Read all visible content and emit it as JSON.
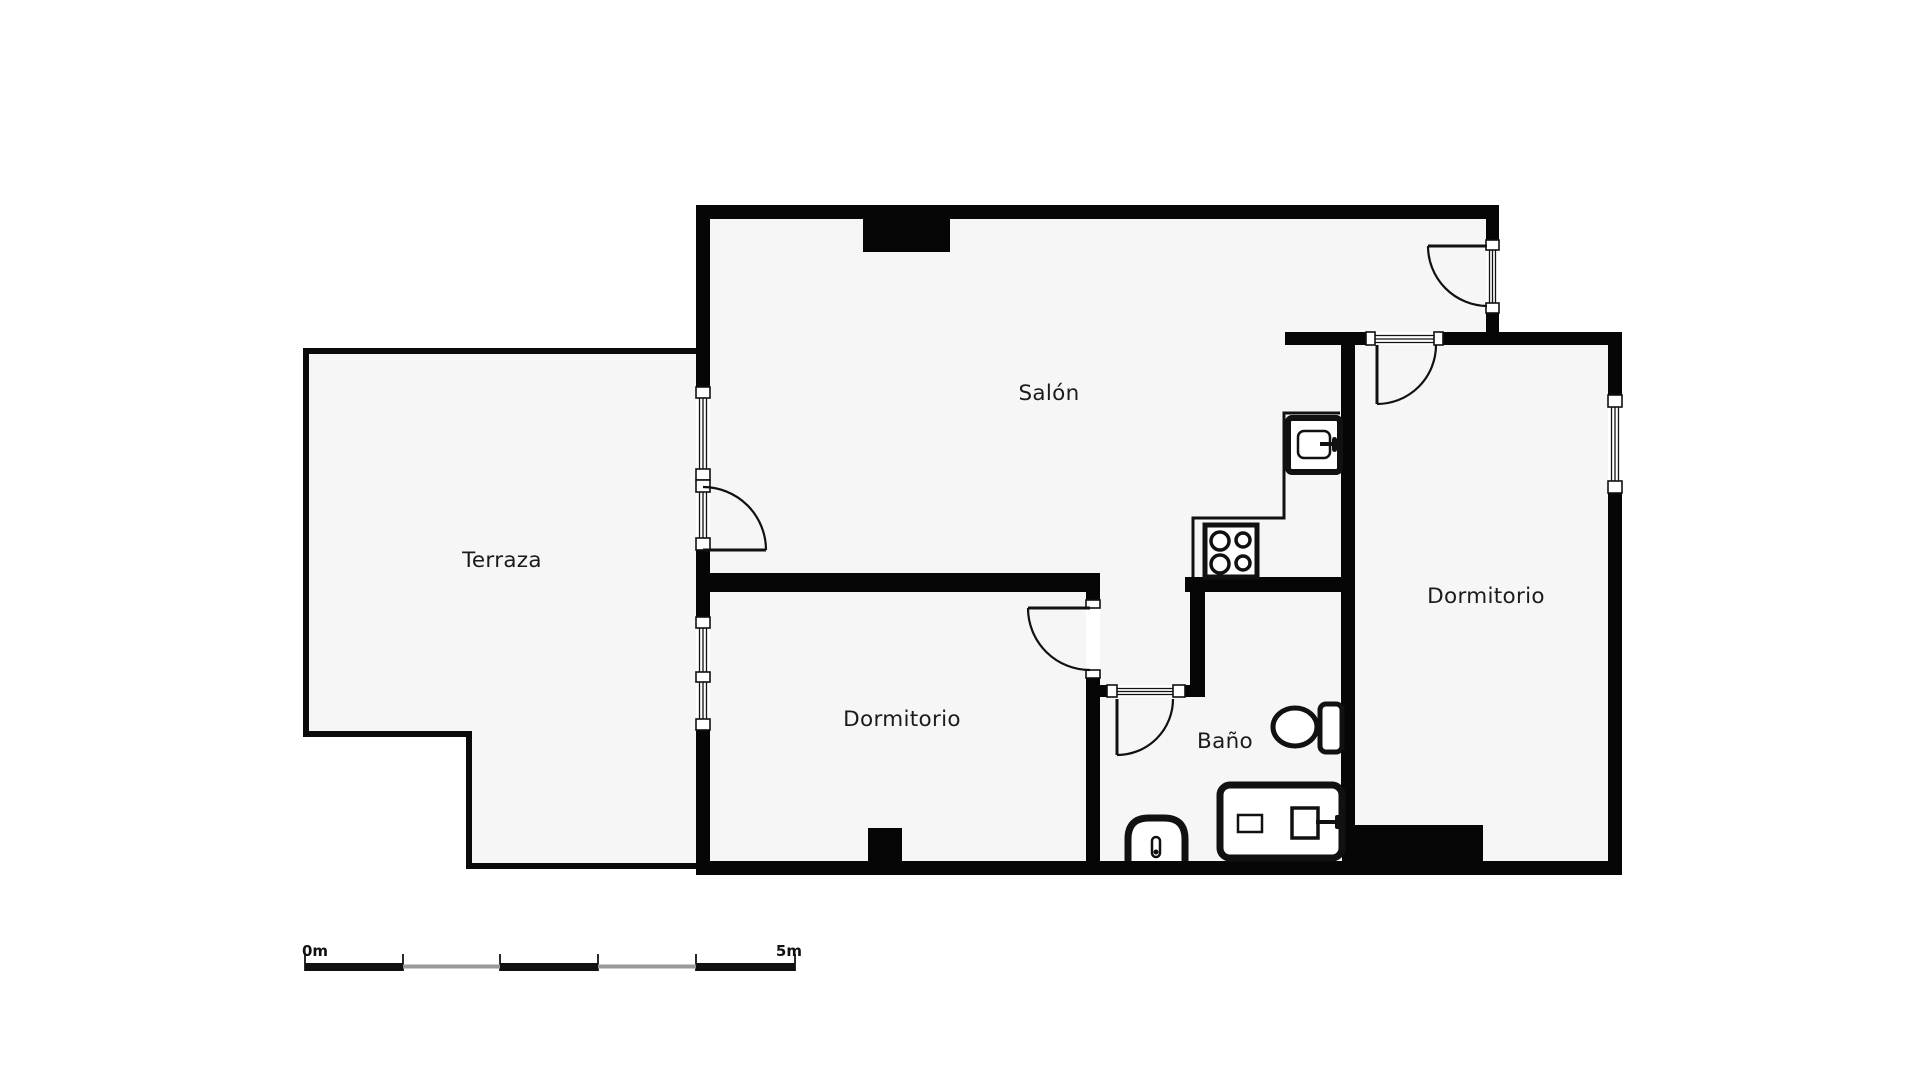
{
  "page": {
    "title": "Floor plan",
    "width": 1920,
    "height": 1080,
    "background": "#ffffff",
    "floor_fill": "#f6f6f6",
    "wall_color": "#060606",
    "thin_wall_color": "#0a0a0a",
    "line_color": "#111111",
    "label_color": "#1b1b1b",
    "scale_gray": "#999999"
  },
  "rooms": [
    {
      "id": "salon",
      "label": "Salón",
      "x": 1049,
      "y": 400
    },
    {
      "id": "terraza",
      "label": "Terraza",
      "x": 502,
      "y": 567
    },
    {
      "id": "dormitorio-izq",
      "label": "Dormitorio",
      "x": 902,
      "y": 726
    },
    {
      "id": "bano",
      "label": "Baño",
      "x": 1225,
      "y": 748
    },
    {
      "id": "dormitorio-der",
      "label": "Dormitorio",
      "x": 1486,
      "y": 603
    }
  ],
  "floors": [
    {
      "id": "building-floor",
      "points": "696,205 1499,205 1499,332 1622,332 1622,875 696,875"
    },
    {
      "id": "terraza-floor",
      "points": "303,348 696,348 696,869 466,869 466,737 303,737"
    }
  ],
  "thick_walls": [
    [
      696,
      205,
      803,
      14
    ],
    [
      696,
      205,
      14,
      670
    ],
    [
      696,
      861,
      926,
      14
    ],
    [
      1608,
      332,
      14,
      543
    ],
    [
      1486,
      205,
      13,
      140
    ],
    [
      1285,
      332,
      335,
      13
    ],
    [
      696,
      573,
      404,
      19
    ],
    [
      1086,
      573,
      14,
      288
    ],
    [
      1341,
      332,
      14,
      495
    ],
    [
      1185,
      577,
      170,
      15
    ],
    [
      1190,
      592,
      15,
      105
    ],
    [
      1100,
      685,
      105,
      12
    ]
  ],
  "blocks": [
    {
      "id": "column-top",
      "r": [
        863,
        219,
        87,
        33
      ]
    },
    {
      "id": "column-bottom",
      "r": [
        868,
        828,
        34,
        33
      ]
    },
    {
      "id": "wardrobe-block",
      "r": [
        1342,
        825,
        141,
        50
      ]
    }
  ],
  "thin_walls": [
    [
      303,
      348,
      393,
      6
    ],
    [
      303,
      348,
      6,
      389
    ],
    [
      303,
      731,
      166,
      6
    ],
    [
      466,
      731,
      6,
      138
    ],
    [
      466,
      863,
      230,
      6
    ]
  ],
  "openings": [
    [
      696,
      387,
      14,
      93
    ],
    [
      696,
      480,
      14,
      70
    ],
    [
      696,
      617,
      14,
      113
    ],
    [
      1486,
      240,
      13,
      73
    ],
    [
      1608,
      395,
      14,
      98
    ],
    [
      1366,
      332,
      77,
      13
    ],
    [
      1086,
      600,
      14,
      78
    ],
    [
      1117,
      685,
      56,
      12
    ]
  ],
  "windows": [
    {
      "id": "window-salon-west",
      "frames": [
        [
          696,
          387,
          14,
          11
        ],
        [
          696,
          469,
          14,
          11
        ]
      ],
      "lines": [
        [
          699.5,
          398,
          699.5,
          469
        ],
        [
          703,
          398,
          703,
          469
        ],
        [
          706.5,
          398,
          706.5,
          469
        ]
      ]
    },
    {
      "id": "window-dormitorio-west",
      "frames": [
        [
          696,
          617,
          14,
          11
        ],
        [
          696,
          672,
          14,
          10
        ],
        [
          696,
          719,
          14,
          11
        ]
      ],
      "lines": [
        [
          699.5,
          628,
          699.5,
          672
        ],
        [
          703,
          628,
          703,
          672
        ],
        [
          706.5,
          628,
          706.5,
          672
        ],
        [
          699.5,
          682,
          699.5,
          719
        ],
        [
          703,
          682,
          703,
          719
        ],
        [
          706.5,
          682,
          706.5,
          719
        ]
      ]
    },
    {
      "id": "window-dormitorio-east",
      "frames": [
        [
          1608,
          395,
          14,
          12
        ],
        [
          1608,
          481,
          14,
          12
        ]
      ],
      "lines": [
        [
          1611.5,
          407,
          1611.5,
          481
        ],
        [
          1615,
          407,
          1615,
          481
        ],
        [
          1618.5,
          407,
          1618.5,
          481
        ]
      ]
    }
  ],
  "doors": [
    {
      "id": "door-terraza-salon",
      "frames": [
        [
          696,
          480,
          14,
          12
        ],
        [
          696,
          538,
          14,
          12
        ]
      ],
      "lines": [
        [
          699.5,
          492,
          699.5,
          538
        ],
        [
          703,
          492,
          703,
          538
        ],
        [
          706.5,
          492,
          706.5,
          538
        ]
      ],
      "leaf": [
        703,
        550,
        766,
        550
      ],
      "arc": "M766,550 A63 63 0 0 0 703,487"
    },
    {
      "id": "door-salon-balcony",
      "frames": [
        [
          1486,
          240,
          13,
          10
        ],
        [
          1486,
          303,
          13,
          10
        ]
      ],
      "lines": [
        [
          1489.5,
          250,
          1489.5,
          303
        ],
        [
          1492.5,
          250,
          1492.5,
          303
        ],
        [
          1495.5,
          250,
          1495.5,
          303
        ]
      ],
      "leaf": [
        1428,
        246,
        1487,
        246
      ],
      "arc": "M1428,246 A60 60 0 0 0 1487,306"
    },
    {
      "id": "door-dormitorio-der",
      "frames": [
        [
          1366,
          332,
          9,
          13
        ],
        [
          1434,
          332,
          9,
          13
        ]
      ],
      "lines": [
        [
          1375,
          335.5,
          1434,
          335.5
        ],
        [
          1375,
          339,
          1434,
          339
        ],
        [
          1375,
          342.5,
          1434,
          342.5
        ]
      ],
      "leaf": [
        1377,
        345,
        1377,
        404
      ],
      "arc": "M1377,404 A59 59 0 0 0 1436,345"
    },
    {
      "id": "door-dormitorio-izq",
      "frames": [
        [
          1086,
          600,
          14,
          8
        ],
        [
          1086,
          670,
          14,
          8
        ]
      ],
      "lines": [],
      "leaf": [
        1028,
        608,
        1090,
        608
      ],
      "arc": "M1028,608 A62 62 0 0 0 1090,670"
    },
    {
      "id": "door-bano",
      "frames": [
        [
          1107,
          685,
          10,
          12
        ],
        [
          1173,
          685,
          12,
          12
        ]
      ],
      "lines": [
        [
          1117,
          688.5,
          1173,
          688.5
        ],
        [
          1117,
          691.5,
          1173,
          691.5
        ],
        [
          1117,
          694.5,
          1173,
          694.5
        ]
      ],
      "leaf": [
        1117,
        699,
        1117,
        755
      ],
      "arc": "M1173,699 A56 56 0 0 1 1117,755"
    }
  ],
  "kitchen": {
    "counter_path": "M1340,413 L1284,413 L1284,518 L1193,518 L1193,577",
    "sink": {
      "outer": [
        1288,
        418,
        52,
        54
      ],
      "inner": [
        1298,
        431,
        32,
        27
      ],
      "faucet": [
        1320,
        444,
        1334,
        444
      ],
      "handle": [
        1332,
        437,
        5,
        15
      ]
    },
    "stove": {
      "box": [
        1205,
        525,
        52,
        52
      ],
      "burners": [
        [
          1220,
          541,
          9
        ],
        [
          1243,
          540,
          7
        ],
        [
          1220,
          564,
          9
        ],
        [
          1243,
          563,
          7
        ]
      ]
    }
  },
  "bathroom": {
    "toilet": {
      "bowl": [
        1295,
        727,
        22,
        19
      ],
      "tank": [
        1320,
        704,
        22,
        48
      ]
    },
    "vanity": {
      "box": [
        1220,
        785,
        122,
        73
      ],
      "soap": [
        1238,
        815,
        24,
        17
      ],
      "basin": [
        1292,
        808,
        26,
        30
      ],
      "faucet": [
        1316,
        822,
        1337,
        822
      ],
      "handle": [
        1335,
        815,
        5,
        14
      ]
    },
    "bidet": {
      "outline": "M1128,861 L1128,839 Q1128,818 1149,818 L1164,818 Q1185,818 1185,839 L1185,861",
      "pill": [
        1152,
        837,
        8,
        20
      ],
      "dot": [
        1156,
        852,
        2.5
      ]
    }
  },
  "scale_bar": {
    "start_label": "0m",
    "end_label": "5m",
    "start_label_pos": [
      302,
      956
    ],
    "end_label_pos": [
      802,
      956
    ],
    "ticks_x": [
      305,
      403,
      500,
      598,
      696,
      795
    ],
    "tick_y": [
      954,
      971
    ],
    "black_segments": [
      [
        305,
        963,
        98,
        8
      ],
      [
        500,
        963,
        98,
        8
      ],
      [
        696,
        963,
        99,
        8
      ]
    ],
    "gray_segments": [
      [
        403,
        964.5,
        97,
        4
      ],
      [
        598,
        964.5,
        98,
        4
      ]
    ]
  }
}
